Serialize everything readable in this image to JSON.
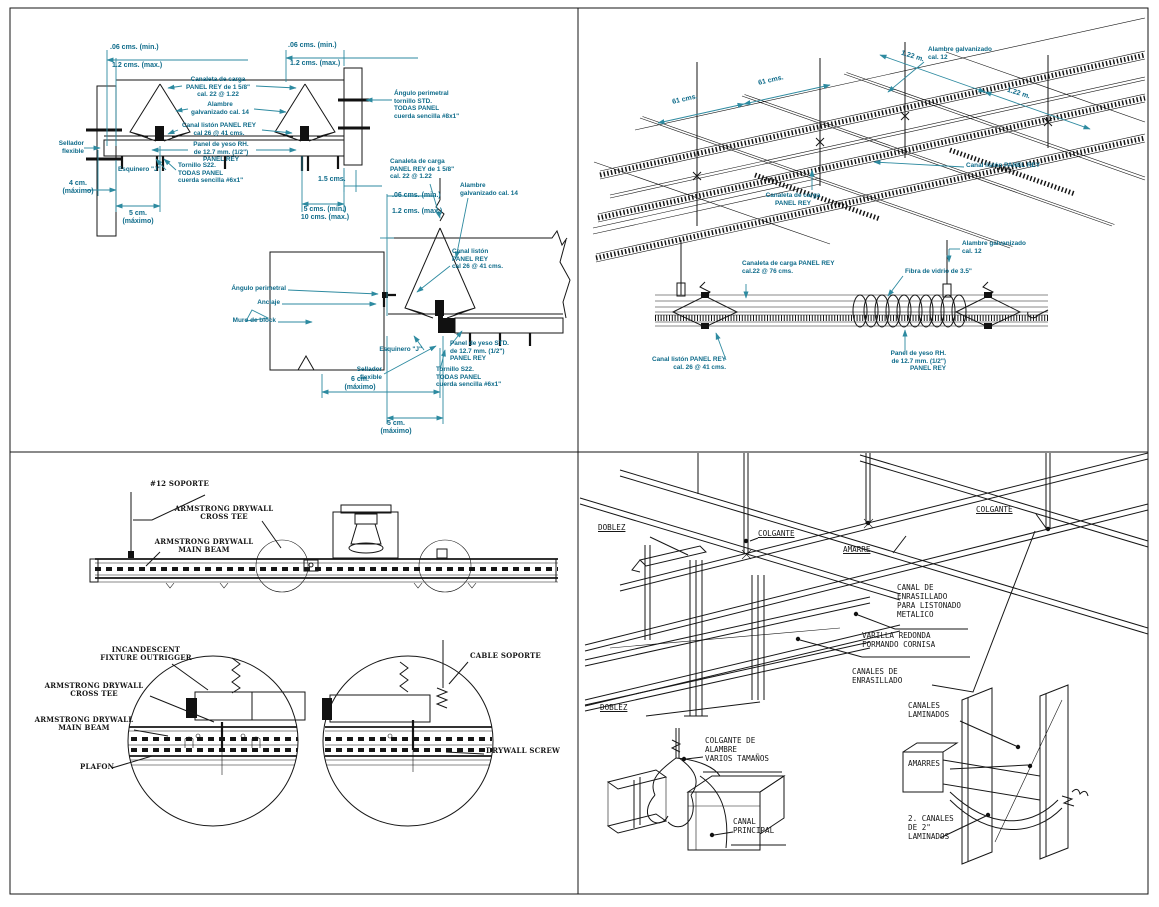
{
  "sheet": {
    "description": "Ceiling construction details CAD sheet, four quadrants"
  },
  "colors": {
    "background": "#ffffff",
    "linework": "#161616",
    "annotation_teal": "#0e6b8a",
    "dimension_line_teal": "#2d8aa0"
  },
  "tl": {
    "tl01": ".06 cms. (min.)",
    "tl02": "1.2 cms. (max.)",
    "tl03": ".06 cms. (min.)",
    "tl04": "1.2 cms. (max.)",
    "tl05": "Canaleta de carga\nPANEL REY de 1 5/8\"\ncal. 22 @ 1.22",
    "tl06": "Alambre\ngalvanizado cal. 14",
    "tl07": "Canal listón PANEL REY\ncal 26 @ 41 cms.",
    "tl08": "Panel de yeso RH.\nde 12.7 mm. (1/2\")\nPANEL REY",
    "tl09": "Sellador\nflexible",
    "tl10": "Esquinero \"J\"",
    "tl11": "Tornillo S22.\nTODAS PANEL\ncuerda sencilla #6x1\"",
    "tl12": "4 cm.\n(máximo)",
    "tl13": "5 cm.\n(máximo)",
    "tl14": "1.5 cms.",
    "tl15": "5 cms. (min.)\n10 cms. (max.)",
    "tl16": "Ángulo perimetral\ntornillo STD.\nTODAS PANEL\ncuerda sencilla #8x1\"",
    "tl17": "Canaleta de carga\nPANEL REY de 1 5/8\"\ncal. 22 @ 1.22",
    "tl18": ".06 cms. (min.)",
    "tl19": "1.2 cms. (max.)",
    "tl20": "Alambre\ngalvanizado cal. 14",
    "tl21": "Ángulo perimetral",
    "tl22": "Anclaje",
    "tl23": "Muro de block",
    "tl24": "Canal listón\nPANEL REY\ncal 26 @ 41 cms.",
    "tl25": "Esquinero \"J\"",
    "tl26": "Panel de yeso STD.\nde 12.7 mm. (1/2\")\nPANEL REY",
    "tl27": "Sellador\nflexible",
    "tl28": "Tornillo S22.\nTODAS PANEL\ncuerda sencilla #6x1\"",
    "tl29": "6 cm.\n(máximo)",
    "tl30": "5 cm.\n(máximo)"
  },
  "tr": {
    "tr01": "61 cms.",
    "tr02": "61 cms.",
    "tr03": "1.22 m.",
    "tr04": "1.22 m.",
    "tr05": "Alambre galvanizado\ncal. 12",
    "tr06": "Canal listón PANEL REY",
    "tr07": "Canaleta de carga\nPANEL REY",
    "tr08": "Canaleta de carga PANEL REY\ncal.22 @ 76 cms.",
    "tr09": "Fibra de vidrio de 3.5\"",
    "tr10": "Alambre galvanizado\ncal. 12",
    "tr11": "Canal listón PANEL REY\ncal. 26 @ 41 cms.",
    "tr12": "Panel de yeso RH.\nde 12.7 mm. (1/2\")\nPANEL REY"
  },
  "bl": {
    "bl01": "#12 SOPORTE",
    "bl02": "ARMSTRONG DRYWALL\nCROSS TEE",
    "bl03": "ARMSTRONG DRYWALL\nMAIN BEAM",
    "bl04": "INCANDESCENT\nFIXTURE OUTRIGGER",
    "bl05": "ARMSTRONG DRYWALL\nCROSS TEE",
    "bl06": "ARMSTRONG DRYWALL\nMAIN BEAM",
    "bl07": "PLAFON",
    "bl08": "CABLE SOPORTE",
    "bl09": "DRYWALL SCREW"
  },
  "br": {
    "br01": "DOBLEZ",
    "br02": "COLGANTE",
    "br03": "COLGANTE",
    "br04": "AMARRE",
    "br05": "CANAL DE\nENRASILLADO\nPARA LISTONADO\nMETALICO",
    "br06": "VARILLA REDONDA\nFORMANDO CORNISA",
    "br07": "CANALES DE\nENRASILLADO",
    "br08": "DOBLEZ",
    "br09": "COLGANTE DE\nALAMBRE\nVARIOS TAMAÑOS",
    "br10": "CANAL\nPRINCIPAL",
    "br11": "CANALES\nLAMINADOS",
    "br12": "AMARRES",
    "br13": "2. CANALES\nDE 2\"\nLAMINADOS"
  }
}
